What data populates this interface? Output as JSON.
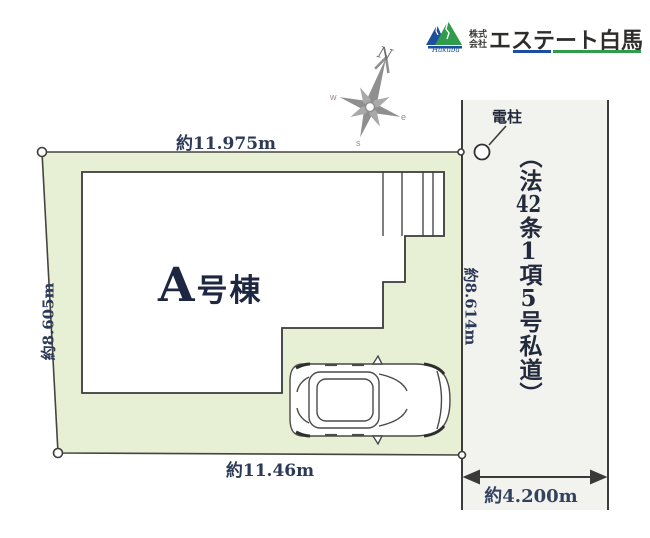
{
  "logo": {
    "prefix_line1": "株式",
    "prefix_line2": "会社",
    "company_name": "エステート白馬",
    "mark_script": "Hakuba",
    "colors": {
      "blue": "#1d4f9e",
      "green": "#2f9b4b",
      "text": "#2e2d2b"
    }
  },
  "compass": {
    "north": "N",
    "west": "w",
    "south": "s",
    "east": "e"
  },
  "plot": {
    "building_label": "A号棟",
    "fill_color": "#e7efd5",
    "measurements": {
      "top": "約11.975m",
      "left": "約8.605m",
      "bottom": "約11.46m",
      "right": "約8.614m"
    }
  },
  "road": {
    "fill_color": "#f2f2ef",
    "utility_pole_label": "電柱",
    "width_label": "約4.200m",
    "label_full": "（法42条1項5号私道）",
    "label_segments": [
      {
        "t": "（法"
      },
      {
        "t": "42"
      },
      {
        "t": "条"
      },
      {
        "t": "1"
      },
      {
        "t": "項"
      },
      {
        "t": "5"
      },
      {
        "t": "号私道）"
      }
    ]
  },
  "colors": {
    "outline": "#3c3c3a",
    "measurement_text": "#2c3a58",
    "compass_gray": "#8f8f8f"
  }
}
